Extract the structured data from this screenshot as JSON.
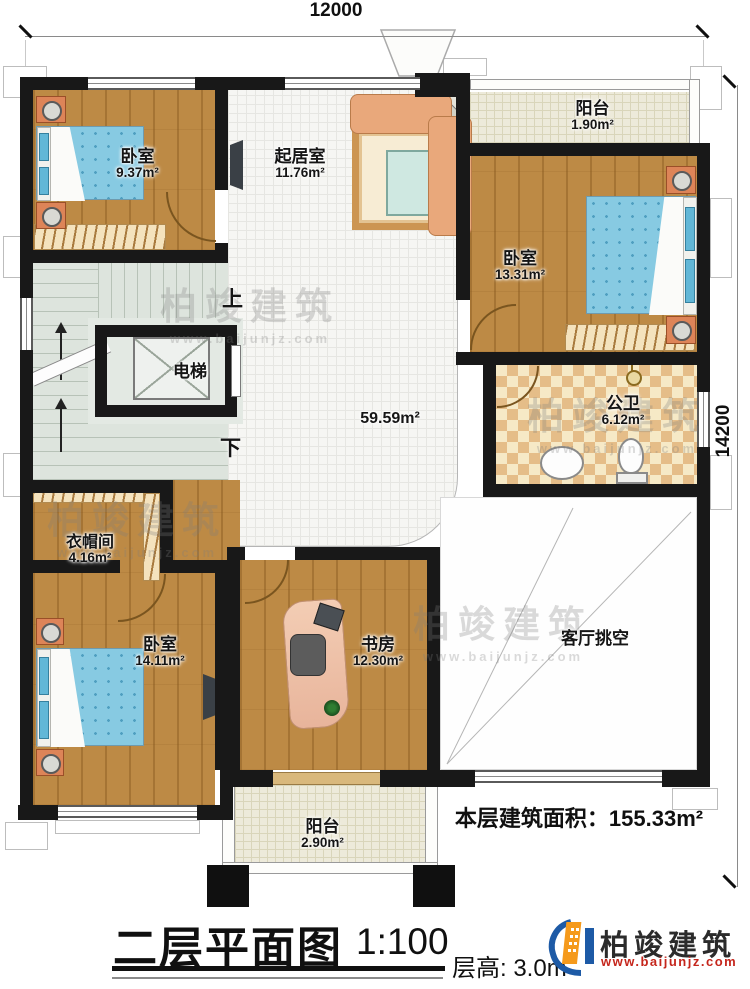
{
  "dimensions": {
    "top": "12000",
    "right": "14200"
  },
  "rooms": {
    "bedroom_top_left": {
      "name": "卧室",
      "area": "9.37m²"
    },
    "living": {
      "name": "起居室",
      "area": "11.76m²"
    },
    "balcony_top": {
      "name": "阳台",
      "area": "1.90m²"
    },
    "bedroom_top_right": {
      "name": "卧室",
      "area": "13.31m²"
    },
    "elevator": {
      "name": "电梯"
    },
    "bathroom": {
      "name": "公卫",
      "area": "6.12m²"
    },
    "hall": {
      "area": "59.59m²"
    },
    "cloakroom": {
      "name": "衣帽间",
      "area": "4.16m²"
    },
    "bedroom_bottom_left": {
      "name": "卧室",
      "area": "14.11m²"
    },
    "study": {
      "name": "书房",
      "area": "12.30m²"
    },
    "void": {
      "name": "客厅挑空"
    },
    "balcony_bottom": {
      "name": "阳台",
      "area": "2.90m²"
    }
  },
  "stairs": {
    "up_label": "上",
    "down_label": "下"
  },
  "notes": {
    "floor_area": "本层建筑面积：155.33m²"
  },
  "title_block": {
    "title": "二层平面图",
    "scale": "1:100",
    "floor_height": "层高: 3.0m"
  },
  "brand": {
    "name": "柏竣建筑",
    "url": "www.baijunjz.com"
  },
  "watermark": {
    "name": "柏竣建筑",
    "url": "www.baijunjz.com"
  },
  "colors": {
    "wall": "#181818",
    "wood": "#bd8a45",
    "balcony_tile": "#edeada",
    "bath_tile": "#e5bd88",
    "accent_blue": "#1d5aa6",
    "accent_orange": "#f59a1c",
    "url_red": "#c5261c"
  }
}
